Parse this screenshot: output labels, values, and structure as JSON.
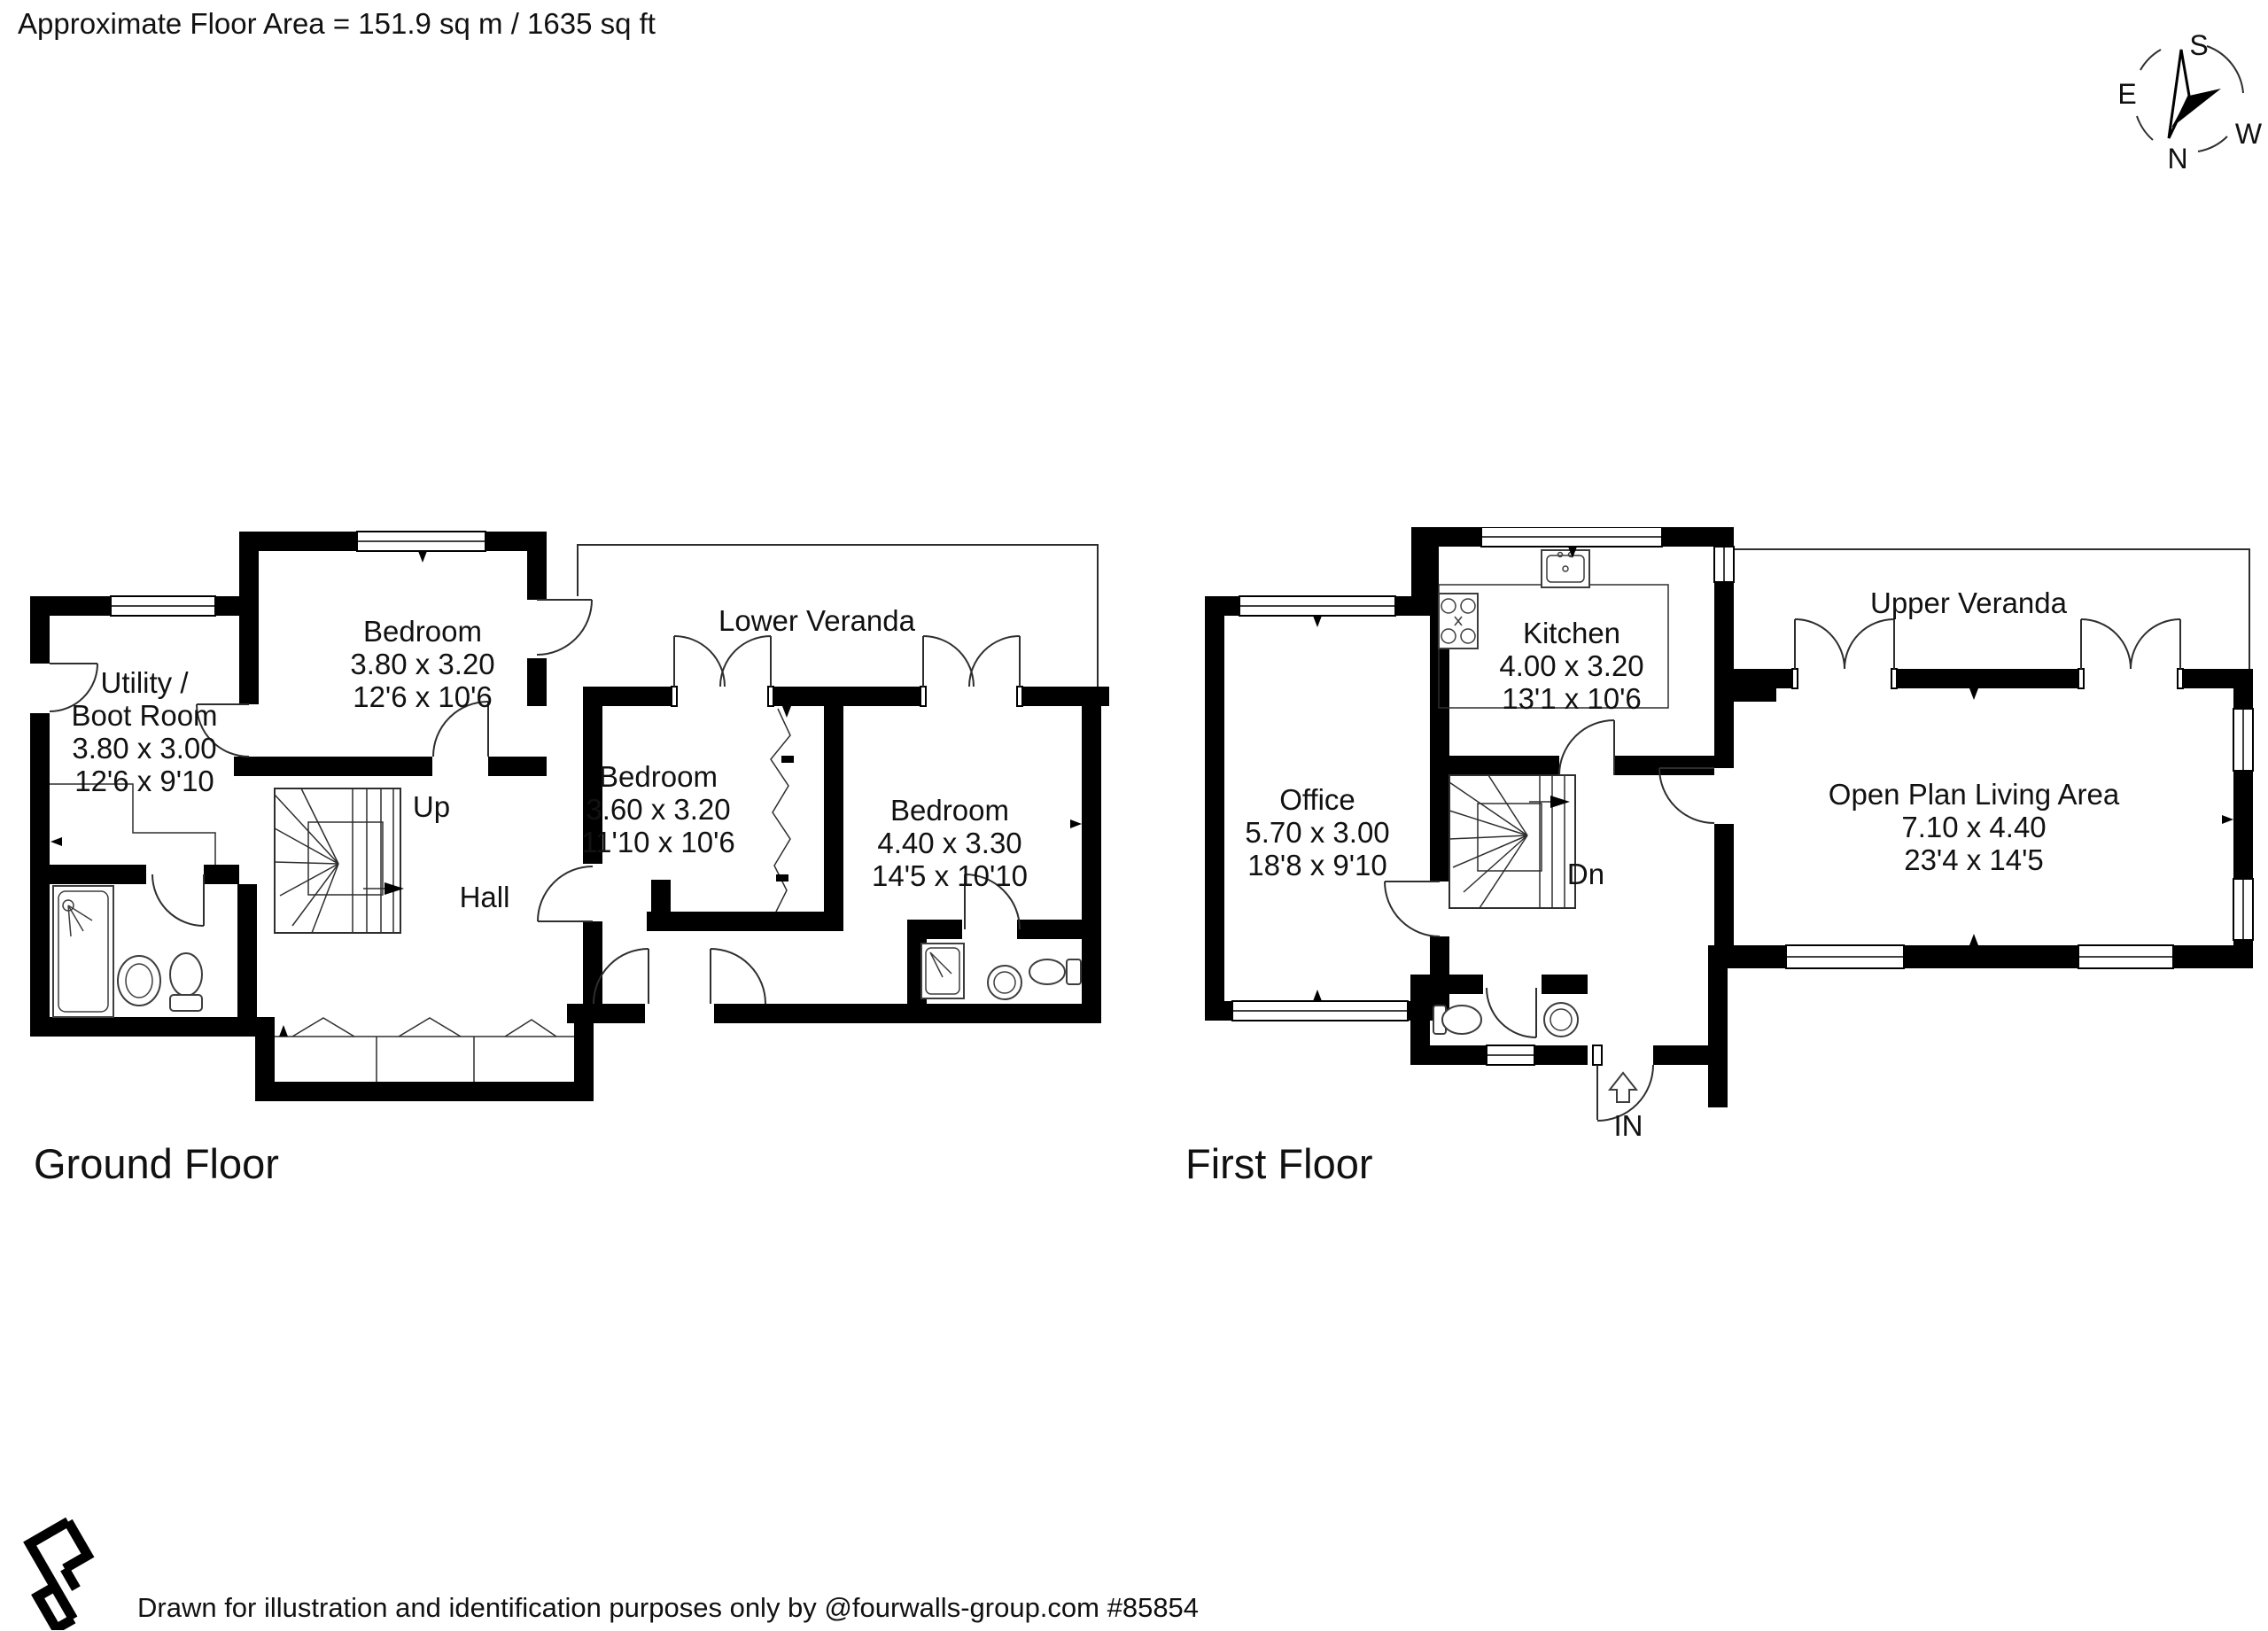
{
  "header": {
    "floor_area": "Approximate Floor Area = 151.9 sq m / 1635 sq ft"
  },
  "compass": {
    "north": "N",
    "east": "E",
    "south": "S",
    "west": "W"
  },
  "colors": {
    "walls": "#000000",
    "thin_lines": "#2e2e2e",
    "text": "#111111"
  },
  "ground_floor": {
    "title": "Ground Floor",
    "veranda_label": "Lower Veranda",
    "hall_label": "Hall",
    "stairs_label": "Up",
    "rooms": {
      "utility": {
        "name_line1": "Utility /",
        "name_line2": "Boot Room",
        "metric": "3.80 x 3.00",
        "imperial": "12'6 x 9'10"
      },
      "bedroom1": {
        "name": "Bedroom",
        "metric": "3.80 x 3.20",
        "imperial": "12'6 x 10'6"
      },
      "bedroom2": {
        "name": "Bedroom",
        "metric": "3.60 x 3.20",
        "imperial": "11'10 x 10'6"
      },
      "bedroom3": {
        "name": "Bedroom",
        "metric": "4.40 x 3.30",
        "imperial": "14'5 x 10'10"
      }
    }
  },
  "first_floor": {
    "title": "First Floor",
    "veranda_label": "Upper Veranda",
    "stairs_label": "Dn",
    "entrance_label": "IN",
    "rooms": {
      "kitchen": {
        "name": "Kitchen",
        "metric": "4.00 x 3.20",
        "imperial": "13'1 x 10'6"
      },
      "office": {
        "name": "Office",
        "metric": "5.70 x 3.00",
        "imperial": "18'8 x 9'10"
      },
      "living": {
        "name": "Open Plan Living Area",
        "metric": "7.10 x 4.40",
        "imperial": "23'4 x 14'5"
      }
    }
  },
  "footer": {
    "disclaimer": "Drawn for illustration and identification purposes only by @fourwalls-group.com #85854"
  }
}
